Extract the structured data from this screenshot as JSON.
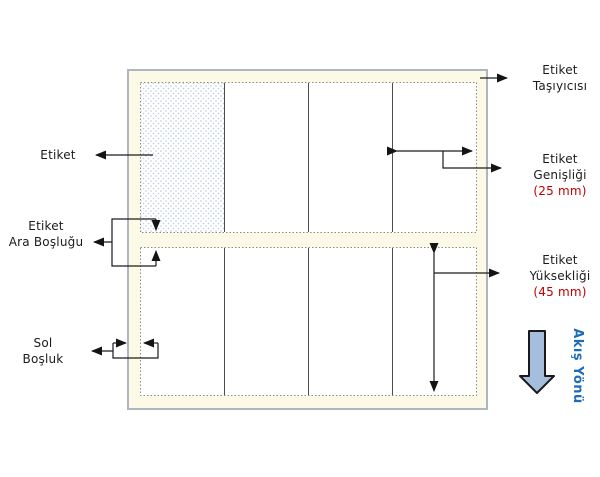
{
  "diagram": {
    "annotations": {
      "etiket": {
        "text": "Etiket"
      },
      "etiket_tasiyicisi": {
        "line1": "Etiket",
        "line2": "Taşıyıcısı"
      },
      "etiket_genisligi": {
        "line1": "Etiket",
        "line2": "Genişliği",
        "value": "(25 mm)"
      },
      "etiket_ara_boslugu": {
        "line1": "Etiket",
        "line2": "Ara Boşluğu"
      },
      "etiket_yuksekligi": {
        "line1": "Etiket",
        "line2": "Yüksekliği",
        "value": "(45 mm)"
      },
      "sol_bosluk": {
        "line1": "Sol",
        "line2": "Boşluk"
      },
      "akis_yonu": {
        "text": "Akış Yönü"
      }
    },
    "values": {
      "label_width_mm": 25,
      "label_height_mm": 45,
      "label_rows": 2,
      "labels_per_row": 4
    },
    "colors": {
      "carrier_fill": "#fdf9e7",
      "carrier_border": "#aeb6c2",
      "label_fill": "#ffffff",
      "label_border": "#8a8a8a",
      "divider": "#4d4d4d",
      "pattern_dot": "#bcc9e2",
      "arrow": "#1c1c1c",
      "dimension_value": "#c00000",
      "flow_arrow_fill": "#a6bede",
      "flow_arrow_border": "#1a1a1a",
      "flow_text": "#1d6cb8",
      "text": "#1b1b1b"
    }
  }
}
